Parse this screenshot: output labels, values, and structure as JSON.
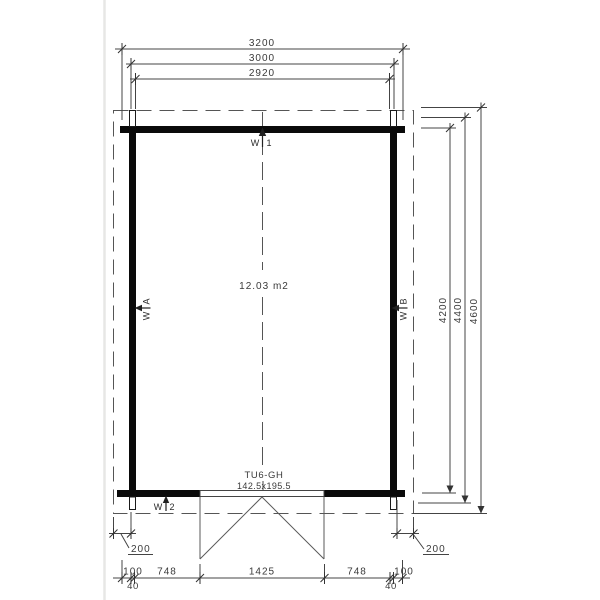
{
  "plan": {
    "area": "12.03 m2",
    "door": {
      "code": "TU6-GH",
      "size": "142.5x195.5"
    },
    "walls": {
      "top": {
        "prefix": "W",
        "suffix": "1"
      },
      "bottom": {
        "prefix": "W",
        "suffix": "2"
      },
      "left": {
        "prefix": "W",
        "suffix": "A"
      },
      "right": {
        "prefix": "W",
        "suffix": "B"
      }
    },
    "dims_top": [
      "3200",
      "3000",
      "2920"
    ],
    "dims_right": [
      "4200",
      "4400",
      "4600"
    ],
    "dims_bottom": [
      "100",
      "748",
      "1425",
      "748",
      "100"
    ],
    "dims_small": [
      "40",
      "40"
    ],
    "offsets": {
      "left": "200",
      "right": "200"
    },
    "colors": {
      "wall": "#0a0a0a",
      "line": "#444444",
      "dashed": "#555555",
      "text": "#3a3a3a",
      "background": "#ffffff"
    }
  }
}
